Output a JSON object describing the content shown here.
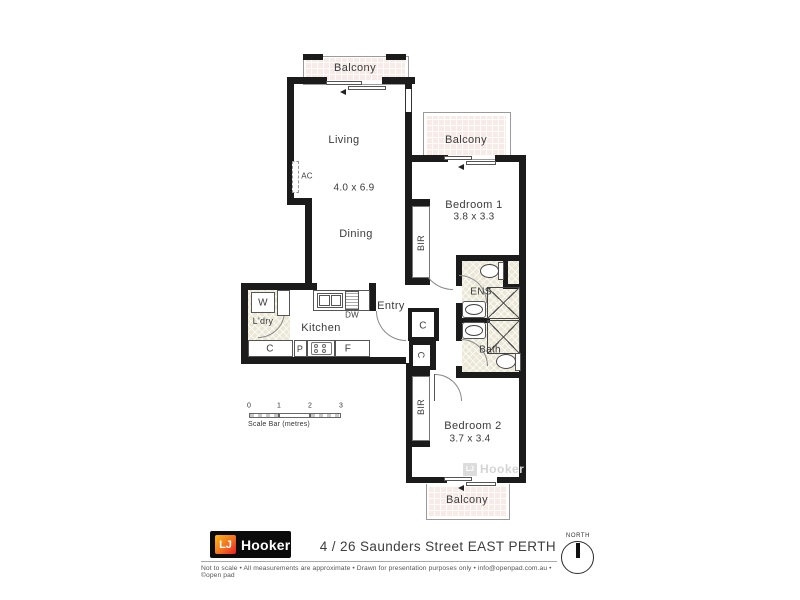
{
  "plan": {
    "rooms": {
      "living": {
        "name": "Living",
        "dims": "4.0 x 6.9"
      },
      "dining": {
        "name": "Dining"
      },
      "kitchen": {
        "name": "Kitchen"
      },
      "laundry": {
        "name": "L'dry"
      },
      "entry": {
        "name": "Entry"
      },
      "bedroom1": {
        "name": "Bedroom 1",
        "dims": "3.8 x 3.3"
      },
      "bedroom2": {
        "name": "Bedroom 2",
        "dims": "3.7 x 3.4"
      },
      "ensuite": {
        "name": "ENS"
      },
      "bathroom": {
        "name": "Bath"
      },
      "balcony_top": {
        "name": "Balcony"
      },
      "balcony_right": {
        "name": "Balcony"
      },
      "balcony_bottom": {
        "name": "Balcony"
      }
    },
    "fixtures": {
      "ac": "AC",
      "washer": "W",
      "dishwasher": "DW",
      "cupboard": "C",
      "pantry": "P",
      "fridge": "F",
      "hall_cupboard_1": "C",
      "hall_cupboard_2": "C",
      "robe1": "BIR",
      "robe2": "BIR"
    },
    "watermark": {
      "lj": "LJ",
      "name": "Hooker"
    }
  },
  "scalebar": {
    "ticks": [
      "0",
      "1",
      "2",
      "3"
    ],
    "label": "Scale Bar (metres)"
  },
  "footer": {
    "logo": {
      "lj": "LJ",
      "name": "Hooker"
    },
    "address": "4 / 26 Saunders Street EAST PERTH",
    "disclaimer": "Not to scale  •  All measurements are approximate  •  Drawn for presentation purposes only  •  info@openpad.com.au  •  ©open pad",
    "north_label": "NORTH"
  },
  "colors": {
    "wall": "#1b1b1b",
    "balcony_fill": "#f7ebe8",
    "tile_fill": "#eae7d5",
    "logo_bg": "#0b0b0b",
    "logo_gradient": [
      "#fdb913",
      "#f37021",
      "#ed1c24"
    ],
    "text": "#3b3b3b"
  }
}
